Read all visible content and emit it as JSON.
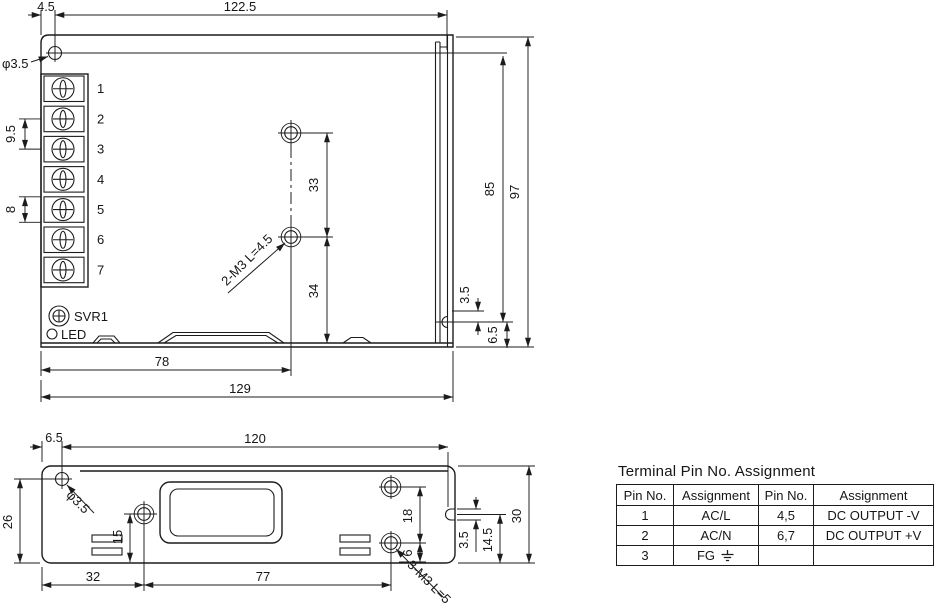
{
  "top_view": {
    "dims": {
      "hole_offset": "4.5",
      "hole_span": "122.5",
      "hole_dia": "φ3.5",
      "terminal_pitch": "9.5",
      "terminal_cell": "8",
      "mount_hole_gap": "33",
      "mount_hole_bottom": "34",
      "screw_note": "2-M3 L=4.5",
      "side_hole_top": "85",
      "height": "97",
      "side_hole_dia": "3.5",
      "side_hole_bottom": "6.5",
      "mount_col": "78",
      "length": "129"
    },
    "terminals": [
      "1",
      "2",
      "3",
      "4",
      "5",
      "6",
      "7"
    ],
    "svr_label": "SVR1",
    "led_label": "LED"
  },
  "bottom_view": {
    "dims": {
      "hole_offset_x": "6.5",
      "hole_span": "120",
      "hole_offset_y": "26",
      "hole_dia": "φ3.5",
      "mid_hole_y": "15",
      "mid_hole_x": "32",
      "right_hole_x": "77",
      "right_hole_gap": "18",
      "right_hole_y": "6",
      "notch_w": "3.5",
      "notch_y": "14.5",
      "height": "30",
      "screw_note": "3-M3 L=5"
    }
  },
  "table": {
    "title": "Terminal Pin No. Assignment",
    "headers": [
      "Pin No.",
      "Assignment",
      "Pin No.",
      "Assignment"
    ],
    "rows": [
      [
        "1",
        "AC/L",
        "4,5",
        "DC OUTPUT -V"
      ],
      [
        "2",
        "AC/N",
        "6,7",
        "DC OUTPUT +V"
      ],
      [
        "3",
        "FG",
        "",
        ""
      ]
    ]
  },
  "colors": {
    "line": "#1c1c1c",
    "bg": "#ffffff"
  }
}
